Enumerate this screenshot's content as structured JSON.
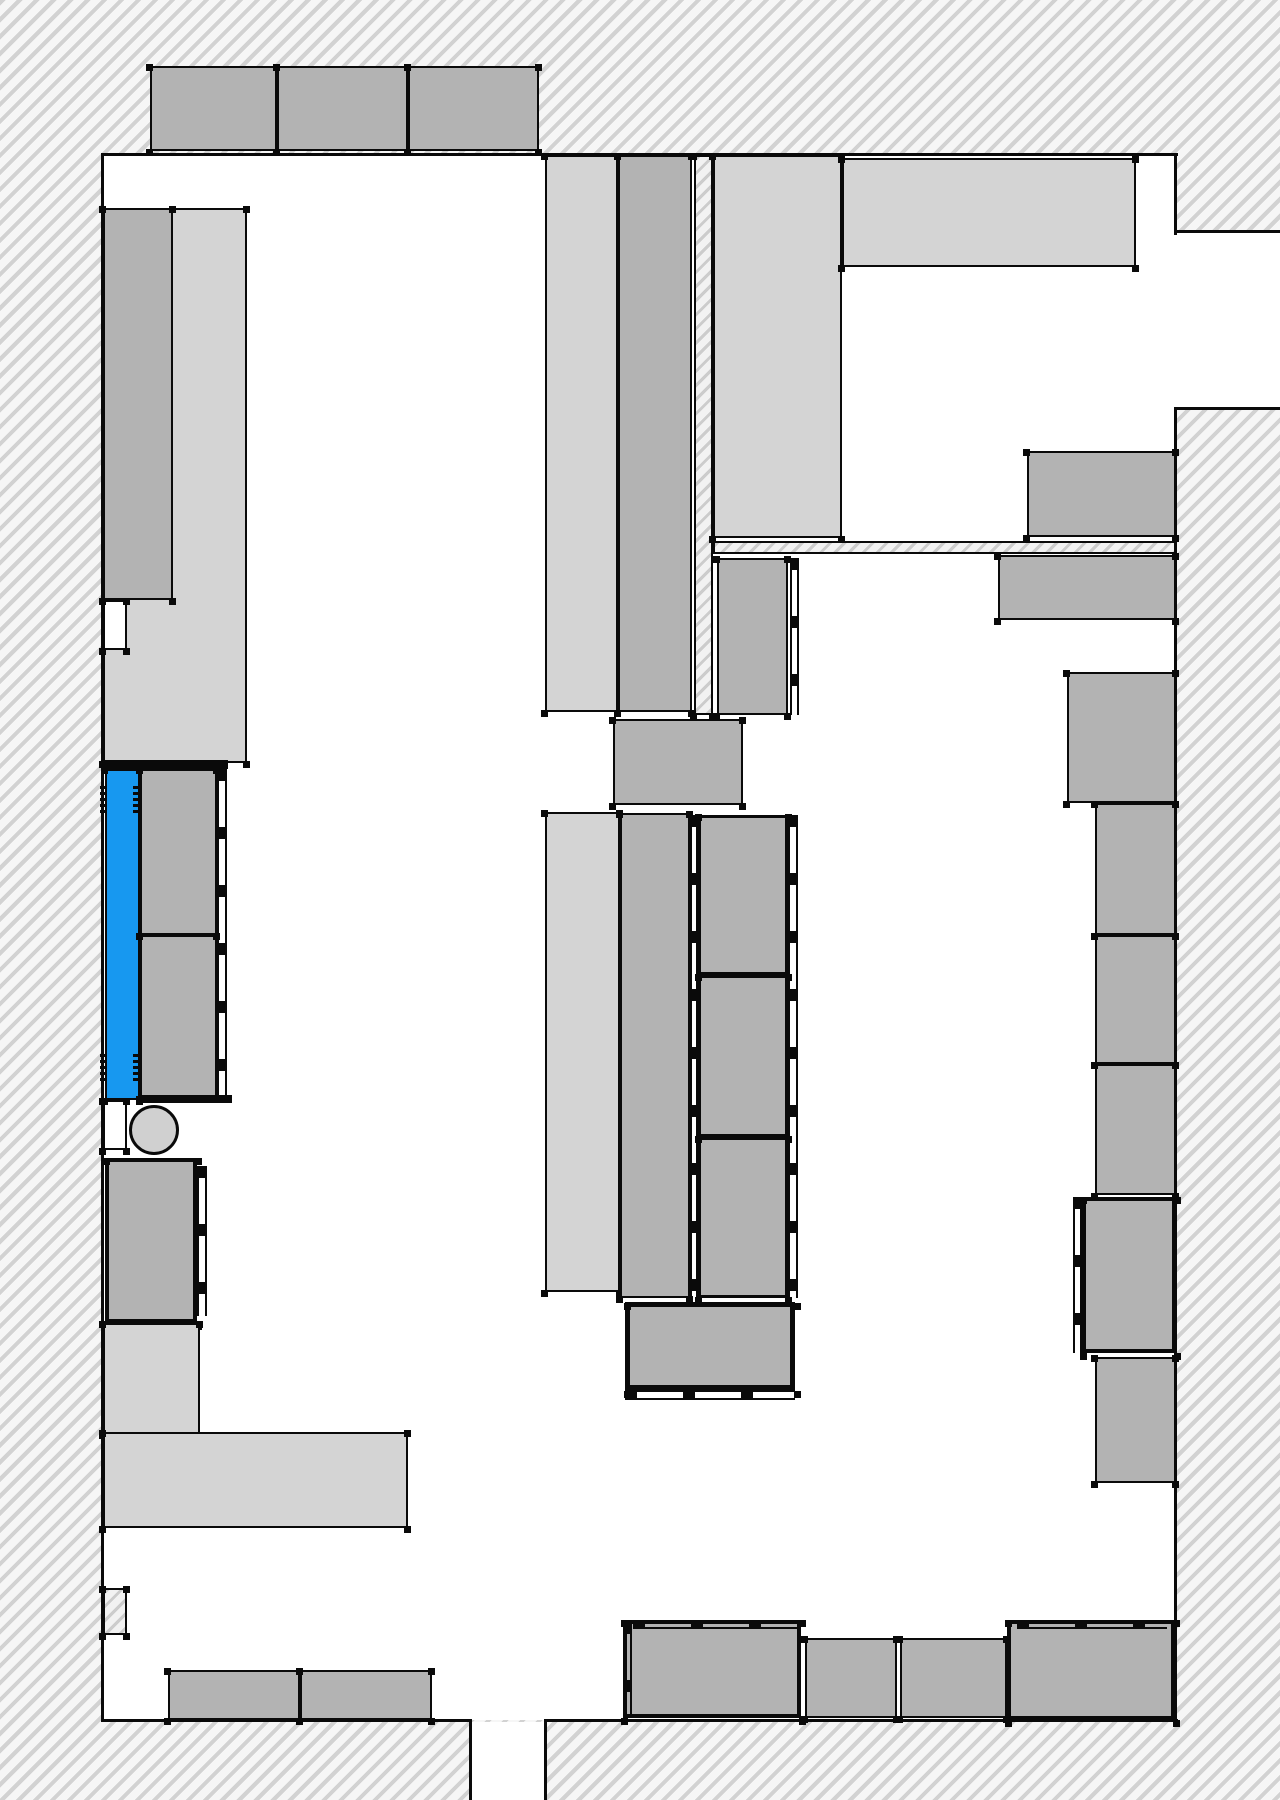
{
  "canvas": {
    "width": 1280,
    "height": 1800
  },
  "colors": {
    "hatch_background": "#f6f6f6",
    "hatch_stripe": "#d2d2d2",
    "light_fixture": "#d4d4d4",
    "medium_fixture": "#b3b3b3",
    "selected_blue": "#1798f0",
    "circle_fill": "#d0d0d0",
    "outline": "#0a0a0a",
    "floor_white": "#ffffff"
  },
  "legend": {
    "blue_meaning": "highlighted-selected-fixture",
    "hatch_meaning": "wall-exterior",
    "white_meaning": "floor-area"
  },
  "elements": [
    {
      "kind": "white",
      "name": "room-floor",
      "x": 103,
      "y": 155,
      "w": 1073,
      "h": 1565,
      "ticks": false,
      "inter": false
    },
    {
      "kind": "white",
      "name": "dock-opening-right",
      "x": 1176,
      "y": 232,
      "w": 104,
      "h": 175,
      "ticks": false,
      "inter": false
    },
    {
      "kind": "white",
      "name": "exit-opening-bottom",
      "x": 471,
      "y": 1722,
      "w": 75,
      "h": 78,
      "ticks": false,
      "inter": false
    },
    {
      "kind": "line",
      "name": "wall-line-top",
      "x": 101,
      "y": 153,
      "w": 1077,
      "h": 3,
      "inter": false
    },
    {
      "kind": "line",
      "name": "wall-line-left",
      "x": 101,
      "y": 153,
      "w": 3,
      "h": 1569,
      "inter": false
    },
    {
      "kind": "line",
      "name": "wall-line-bottom-left",
      "x": 101,
      "y": 1719,
      "w": 370,
      "h": 3,
      "inter": false
    },
    {
      "kind": "line",
      "name": "wall-line-bottom-right",
      "x": 544,
      "y": 1719,
      "w": 634,
      "h": 3,
      "inter": false
    },
    {
      "kind": "line",
      "name": "wall-line-right-upper",
      "x": 1174,
      "y": 153,
      "w": 3,
      "h": 82,
      "inter": false
    },
    {
      "kind": "line",
      "name": "wall-line-right-lower",
      "x": 1174,
      "y": 407,
      "w": 3,
      "h": 1315,
      "inter": false
    },
    {
      "kind": "line",
      "name": "dock-top-edge",
      "x": 1174,
      "y": 230,
      "w": 106,
      "h": 3,
      "inter": false
    },
    {
      "kind": "line",
      "name": "dock-bottom-edge",
      "x": 1177,
      "y": 407,
      "w": 103,
      "h": 3,
      "inter": false
    },
    {
      "kind": "line",
      "name": "exit-jamb-left",
      "x": 469,
      "y": 1719,
      "w": 3,
      "h": 81,
      "inter": false
    },
    {
      "kind": "line",
      "name": "exit-jamb-right",
      "x": 544,
      "y": 1719,
      "w": 3,
      "h": 81,
      "inter": false
    },
    {
      "kind": "hatch",
      "name": "partition-fin-vertical",
      "x": 694,
      "y": 155,
      "w": 19,
      "h": 560,
      "ticks": true,
      "inter": false
    },
    {
      "kind": "hatch",
      "name": "partition-fin-horizontal",
      "x": 713,
      "y": 541,
      "w": 463,
      "h": 13,
      "ticks": false,
      "inter": false
    },
    {
      "kind": "hatch",
      "name": "wall-pilaster-bottom-left",
      "x": 103,
      "y": 1588,
      "w": 24,
      "h": 47,
      "ticks": true,
      "inter": false
    },
    {
      "kind": "rect",
      "name": "top-shelf-1",
      "fill": "medium_fixture",
      "x": 150,
      "y": 66,
      "w": 127,
      "h": 85,
      "ticks": true,
      "inter": true
    },
    {
      "kind": "rect",
      "name": "top-shelf-2",
      "fill": "medium_fixture",
      "x": 277,
      "y": 66,
      "w": 131,
      "h": 85,
      "ticks": true,
      "inter": true
    },
    {
      "kind": "rect",
      "name": "top-shelf-3",
      "fill": "medium_fixture",
      "x": 408,
      "y": 66,
      "w": 131,
      "h": 85,
      "ticks": true,
      "inter": true
    },
    {
      "kind": "rect",
      "name": "left-backdrop-shelf",
      "fill": "light_fixture",
      "x": 103,
      "y": 208,
      "w": 144,
      "h": 555,
      "ticks": true,
      "inter": true
    },
    {
      "kind": "rect",
      "name": "left-wall-shelf",
      "fill": "medium_fixture",
      "x": 103,
      "y": 208,
      "w": 70,
      "h": 392,
      "ticks": true,
      "inter": true
    },
    {
      "kind": "white",
      "name": "wall-recess-upper",
      "x": 103,
      "y": 600,
      "w": 24,
      "h": 50,
      "outlined": true,
      "ticks": true,
      "inter": false
    },
    {
      "kind": "white",
      "name": "wall-recess-lower",
      "x": 103,
      "y": 1100,
      "w": 24,
      "h": 50,
      "outlined": true,
      "ticks": true,
      "inter": false
    },
    {
      "kind": "line",
      "name": "left-counter-top-bar",
      "x": 103,
      "y": 760,
      "w": 125,
      "h": 9,
      "inter": false
    },
    {
      "kind": "rect",
      "name": "selected-blue-fixture",
      "fill": "selected_blue",
      "x": 105,
      "y": 769,
      "w": 35,
      "h": 331,
      "ticks": true,
      "inter": true
    },
    {
      "kind": "hinge",
      "name": "hinge-mark-top-left",
      "x": 100,
      "y": 785,
      "w": 7,
      "h": 28,
      "inter": false
    },
    {
      "kind": "hinge",
      "name": "hinge-mark-top-right",
      "x": 133,
      "y": 785,
      "w": 7,
      "h": 28,
      "inter": false
    },
    {
      "kind": "hinge",
      "name": "hinge-mark-bottom-left",
      "x": 100,
      "y": 1053,
      "w": 7,
      "h": 28,
      "inter": false
    },
    {
      "kind": "hinge",
      "name": "hinge-mark-bottom-right",
      "x": 133,
      "y": 1053,
      "w": 7,
      "h": 28,
      "inter": false
    },
    {
      "kind": "rect",
      "name": "left-counter-upper",
      "fill": "medium_fixture",
      "x": 140,
      "y": 769,
      "w": 77,
      "h": 166,
      "ticks": true,
      "inter": true
    },
    {
      "kind": "rect",
      "name": "left-counter-lower",
      "fill": "medium_fixture",
      "x": 140,
      "y": 935,
      "w": 77,
      "h": 163,
      "ticks": true,
      "inter": true
    },
    {
      "kind": "line",
      "name": "left-counter-bottom-bar",
      "x": 138,
      "y": 1095,
      "w": 94,
      "h": 8,
      "inter": false
    },
    {
      "kind": "railv",
      "name": "left-counter-rail",
      "x": 217,
      "y": 769,
      "w": 10,
      "h": 330,
      "inter": false
    },
    {
      "kind": "rect",
      "name": "left-service-box",
      "fill": "medium_fixture",
      "x": 105,
      "y": 1158,
      "w": 92,
      "h": 165,
      "bw": "bw4",
      "ticks": true,
      "inter": true
    },
    {
      "kind": "railv",
      "name": "left-service-box-rail",
      "x": 197,
      "y": 1166,
      "w": 10,
      "h": 150,
      "inter": false
    },
    {
      "kind": "rect",
      "name": "left-lshape-vertical",
      "fill": "light_fixture",
      "x": 103,
      "y": 1323,
      "w": 97,
      "h": 111,
      "ticks": true,
      "inter": true
    },
    {
      "kind": "rect",
      "name": "left-lshape-horizontal",
      "fill": "light_fixture",
      "x": 103,
      "y": 1432,
      "w": 305,
      "h": 96,
      "ticks": true,
      "inter": true
    },
    {
      "kind": "rect",
      "name": "bottom-left-shelf-1",
      "fill": "medium_fixture",
      "x": 168,
      "y": 1670,
      "w": 132,
      "h": 50,
      "ticks": true,
      "inter": true
    },
    {
      "kind": "rect",
      "name": "bottom-left-shelf-2",
      "fill": "medium_fixture",
      "x": 300,
      "y": 1670,
      "w": 132,
      "h": 50,
      "ticks": true,
      "inter": true
    },
    {
      "kind": "rect",
      "name": "center-aisle1-light-shelf",
      "fill": "light_fixture",
      "x": 545,
      "y": 155,
      "w": 73,
      "h": 557,
      "ticks": true,
      "inter": true
    },
    {
      "kind": "rect",
      "name": "center-aisle1-gray-shelf",
      "fill": "medium_fixture",
      "x": 618,
      "y": 155,
      "w": 74,
      "h": 557,
      "ticks": true,
      "inter": true
    },
    {
      "kind": "rect",
      "name": "center-aisle2-light-shelf",
      "fill": "light_fixture",
      "x": 713,
      "y": 155,
      "w": 129,
      "h": 383,
      "ticks": true,
      "inter": true
    },
    {
      "kind": "rect",
      "name": "center-aisle2-gray-box",
      "fill": "medium_fixture",
      "x": 717,
      "y": 558,
      "w": 71,
      "h": 157,
      "ticks": true,
      "inter": true
    },
    {
      "kind": "railv",
      "name": "center-aisle2-rail",
      "x": 790,
      "y": 558,
      "w": 9,
      "h": 157,
      "inter": false
    },
    {
      "kind": "rect",
      "name": "center-bridge-box",
      "fill": "medium_fixture",
      "x": 613,
      "y": 719,
      "w": 130,
      "h": 86,
      "ticks": true,
      "inter": true
    },
    {
      "kind": "rect",
      "name": "top-center-wide-shelf",
      "fill": "light_fixture",
      "x": 842,
      "y": 158,
      "w": 294,
      "h": 109,
      "ticks": true,
      "inter": true
    },
    {
      "kind": "rect",
      "name": "center-lower-light-slab",
      "fill": "light_fixture",
      "x": 545,
      "y": 812,
      "w": 75,
      "h": 480,
      "ticks": true,
      "inter": true
    },
    {
      "kind": "rect",
      "name": "center-lower-backdrop",
      "fill": "medium_fixture",
      "x": 620,
      "y": 813,
      "w": 70,
      "h": 485,
      "ticks": true,
      "inter": true
    },
    {
      "kind": "railv",
      "name": "center-boxcol-rail-left",
      "x": 690,
      "y": 815,
      "w": 8,
      "h": 483,
      "inter": false
    },
    {
      "kind": "rect",
      "name": "center-box-1",
      "fill": "medium_fixture",
      "x": 698,
      "y": 815,
      "w": 90,
      "h": 160,
      "bw": "bw3",
      "ticks": true,
      "inter": true
    },
    {
      "kind": "rect",
      "name": "center-box-2",
      "fill": "medium_fixture",
      "x": 698,
      "y": 975,
      "w": 90,
      "h": 162,
      "bw": "bw3",
      "ticks": true,
      "inter": true
    },
    {
      "kind": "rect",
      "name": "center-box-3",
      "fill": "medium_fixture",
      "x": 698,
      "y": 1137,
      "w": 90,
      "h": 161,
      "bw": "bw3",
      "ticks": true,
      "inter": true
    },
    {
      "kind": "railv",
      "name": "center-boxcol-rail-right",
      "x": 788,
      "y": 815,
      "w": 10,
      "h": 483,
      "inter": false
    },
    {
      "kind": "rect",
      "name": "center-checkout-box",
      "fill": "medium_fixture",
      "x": 625,
      "y": 1302,
      "w": 170,
      "h": 88,
      "bw": "bw5",
      "ticks": true,
      "inter": true
    },
    {
      "kind": "railh",
      "name": "center-checkout-rail",
      "x": 625,
      "y": 1390,
      "w": 170,
      "h": 10,
      "inter": false
    },
    {
      "kind": "rect",
      "name": "right-shelf-a",
      "fill": "medium_fixture",
      "x": 1027,
      "y": 451,
      "w": 149,
      "h": 86,
      "ticks": true,
      "inter": true
    },
    {
      "kind": "rect",
      "name": "right-shelf-b",
      "fill": "medium_fixture",
      "x": 998,
      "y": 555,
      "w": 178,
      "h": 65,
      "ticks": true,
      "inter": true
    },
    {
      "kind": "rect",
      "name": "right-shelf-c",
      "fill": "medium_fixture",
      "x": 1067,
      "y": 672,
      "w": 109,
      "h": 131,
      "ticks": true,
      "inter": true
    },
    {
      "kind": "rect",
      "name": "right-shelf-d",
      "fill": "medium_fixture",
      "x": 1095,
      "y": 803,
      "w": 81,
      "h": 132,
      "ticks": true,
      "inter": true
    },
    {
      "kind": "rect",
      "name": "right-shelf-e",
      "fill": "medium_fixture",
      "x": 1095,
      "y": 935,
      "w": 81,
      "h": 129,
      "ticks": true,
      "inter": true
    },
    {
      "kind": "rect",
      "name": "right-shelf-f",
      "fill": "medium_fixture",
      "x": 1095,
      "y": 1064,
      "w": 81,
      "h": 131,
      "ticks": true,
      "inter": true
    },
    {
      "kind": "rect",
      "name": "right-shelf-g",
      "fill": "medium_fixture",
      "x": 1082,
      "y": 1197,
      "w": 94,
      "h": 156,
      "bw": "bw4",
      "ticks": true,
      "inter": true
    },
    {
      "kind": "railv",
      "name": "right-shelf-g-rail",
      "x": 1073,
      "y": 1197,
      "w": 9,
      "h": 156,
      "inter": false
    },
    {
      "kind": "rect",
      "name": "right-shelf-h",
      "fill": "medium_fixture",
      "x": 1095,
      "y": 1357,
      "w": 81,
      "h": 126,
      "ticks": true,
      "inter": true
    },
    {
      "kind": "rect",
      "name": "bottom-right-shelf-a",
      "fill": "medium_fixture",
      "x": 623,
      "y": 1620,
      "w": 178,
      "h": 98,
      "bw": "bw4",
      "ticks": true,
      "inter": true
    },
    {
      "kind": "railh",
      "name": "bottom-right-shelf-a-rail",
      "x": 633,
      "y": 1620,
      "w": 168,
      "h": 9,
      "inter": false
    },
    {
      "kind": "railv",
      "name": "bottom-right-shelf-a-rail-left",
      "x": 623,
      "y": 1622,
      "w": 9,
      "h": 96,
      "inter": false
    },
    {
      "kind": "rect",
      "name": "bottom-right-shelf-b",
      "fill": "medium_fixture",
      "x": 805,
      "y": 1638,
      "w": 92,
      "h": 80,
      "ticks": true,
      "inter": true
    },
    {
      "kind": "rect",
      "name": "bottom-right-shelf-c",
      "fill": "medium_fixture",
      "x": 900,
      "y": 1638,
      "w": 107,
      "h": 80,
      "ticks": true,
      "inter": true
    },
    {
      "kind": "rect",
      "name": "bottom-right-shelf-d",
      "fill": "medium_fixture",
      "x": 1007,
      "y": 1620,
      "w": 168,
      "h": 100,
      "bw": "bw4",
      "ticks": true,
      "inter": true
    },
    {
      "kind": "railh",
      "name": "bottom-right-shelf-d-rail",
      "x": 1017,
      "y": 1620,
      "w": 150,
      "h": 9,
      "inter": false
    },
    {
      "kind": "circle",
      "name": "column-circle",
      "x": 129,
      "y": 1105,
      "w": 50,
      "h": 50,
      "fill": "circle_fill",
      "inter": false
    }
  ]
}
